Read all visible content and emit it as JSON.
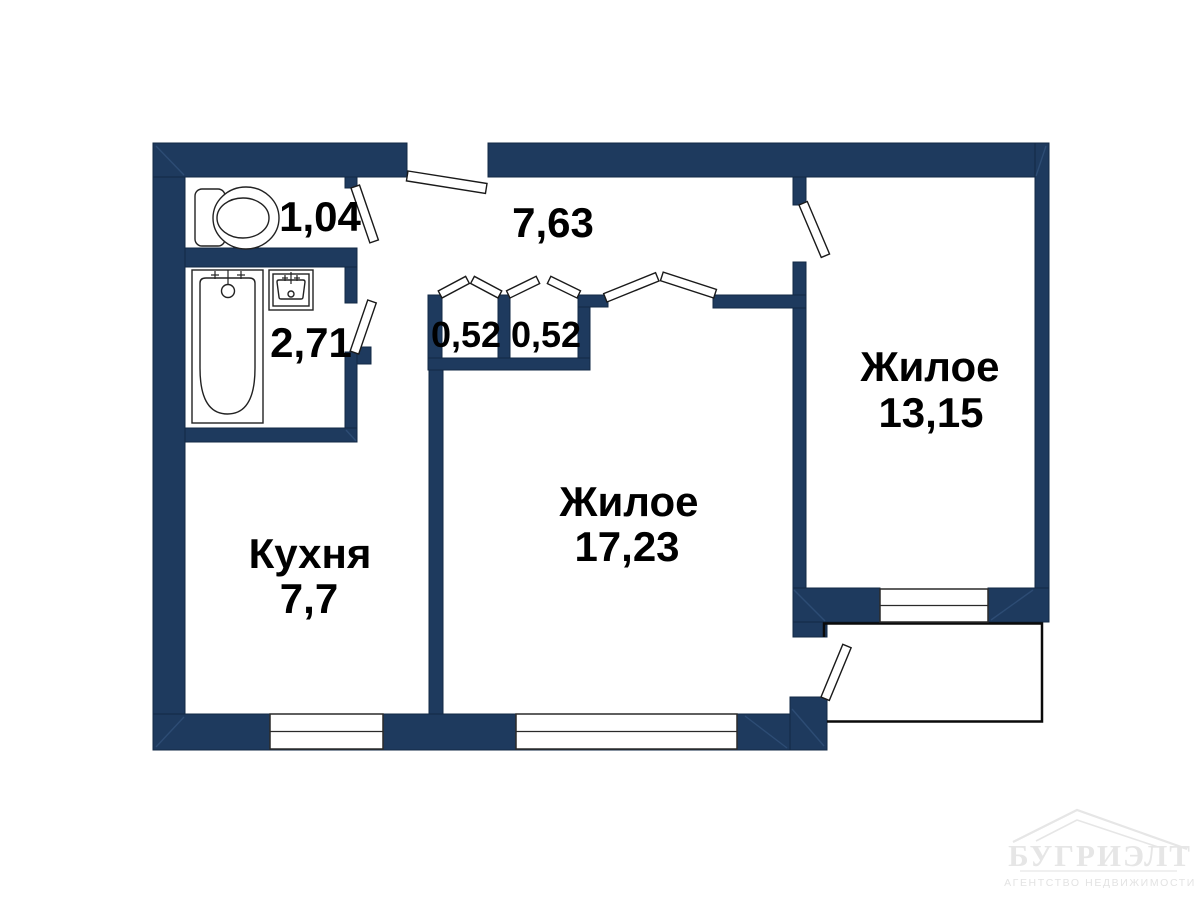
{
  "plan": {
    "wall_color": "#1e3a5e",
    "labels": {
      "hallway_area": "7,63",
      "toilet_area": "1,04",
      "bathroom_area": "2,71",
      "closet_left_area": "0,52",
      "closet_right_area": "0,52",
      "kitchen_name": "Кухня",
      "kitchen_area": "7,7",
      "living_name": "Жилое",
      "living_area": "17,23",
      "bedroom_name": "Жилое",
      "bedroom_area": "13,15"
    }
  },
  "watermark": {
    "brand": "БУГРИЭЛТ",
    "tagline": "АГЕНТСТВО НЕДВИЖИМОСТИ"
  }
}
